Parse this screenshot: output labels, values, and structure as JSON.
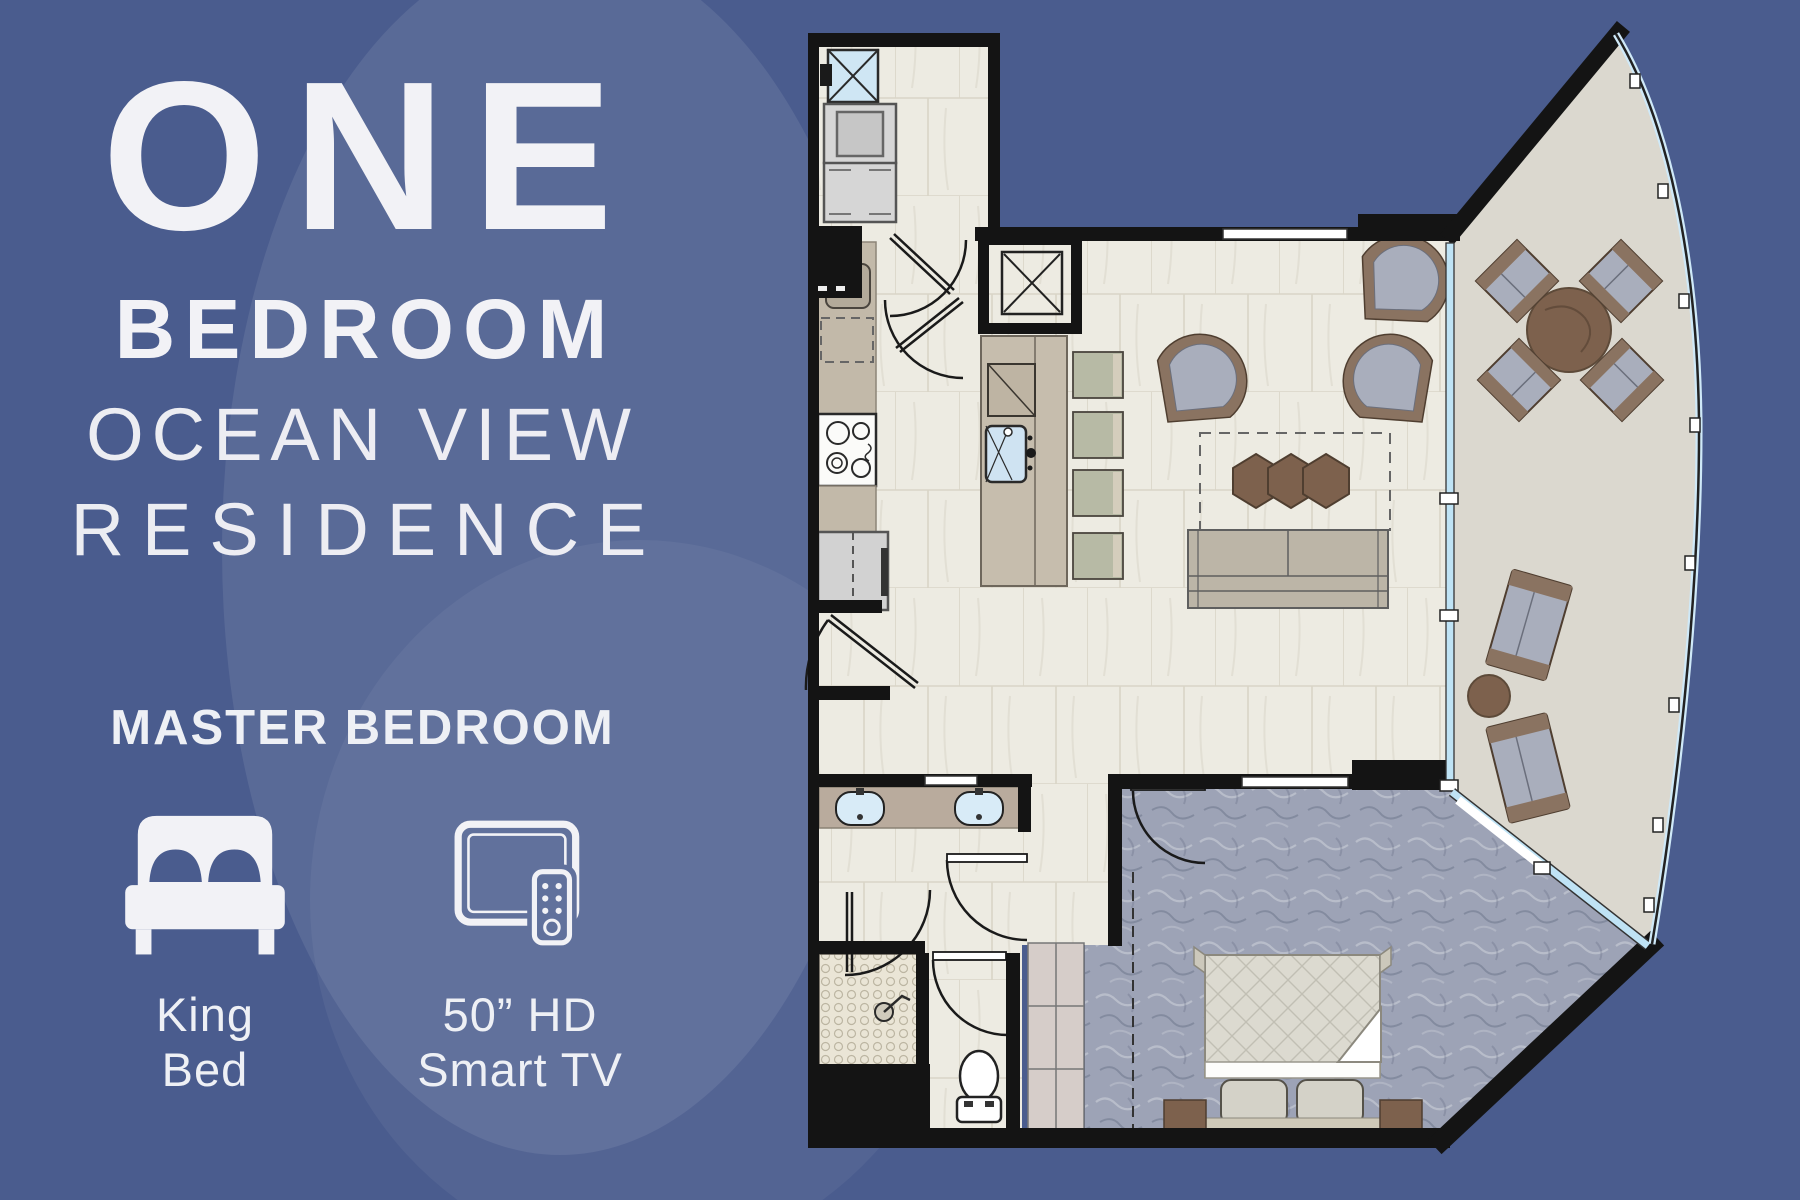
{
  "poster": {
    "title_lines": [
      "ONE",
      "BEDROOM",
      "OCEAN VIEW",
      "RESIDENCE"
    ],
    "section_heading": "MASTER BEDROOM",
    "features": [
      {
        "icon": "king-bed-icon",
        "label_lines": [
          "King",
          "Bed"
        ]
      },
      {
        "icon": "smart-tv-remote-icon",
        "label_lines": [
          "50” HD",
          "Smart TV"
        ]
      }
    ]
  },
  "floorplan": {
    "elements": [
      "laundry-closet",
      "stacked-washer-dryer",
      "utility-sink",
      "kitchen-counter",
      "cooktop",
      "dishwasher",
      "refrigerator",
      "kitchen-island",
      "bar-stools",
      "elevator-shaft",
      "living-room",
      "sofa",
      "hexagon-coffee-tables",
      "lounge-chairs",
      "balcony",
      "round-dining-table",
      "balcony-dining-chairs",
      "balcony-loungers",
      "master-bedroom",
      "king-bed",
      "nightstands",
      "wardrobe-shelves",
      "bathroom",
      "double-vanity",
      "walk-in-shower",
      "toilet-room",
      "sliding-glass-doors"
    ]
  },
  "colors": {
    "background": "#4a5c8e",
    "swirl": "#5a6a9d",
    "text": "#f2f2f6",
    "wall": "#141414",
    "tile_floor": "#edebe2",
    "balcony_floor": "#dbd8cf",
    "carpet": "#9da3b6",
    "wood": "#7d614d",
    "glass": "#bfe3f5",
    "counter": "#c2b9a9",
    "cushion": "#a9aebc",
    "stool": "#b7baa5",
    "fixture_white": "#ffffff"
  }
}
